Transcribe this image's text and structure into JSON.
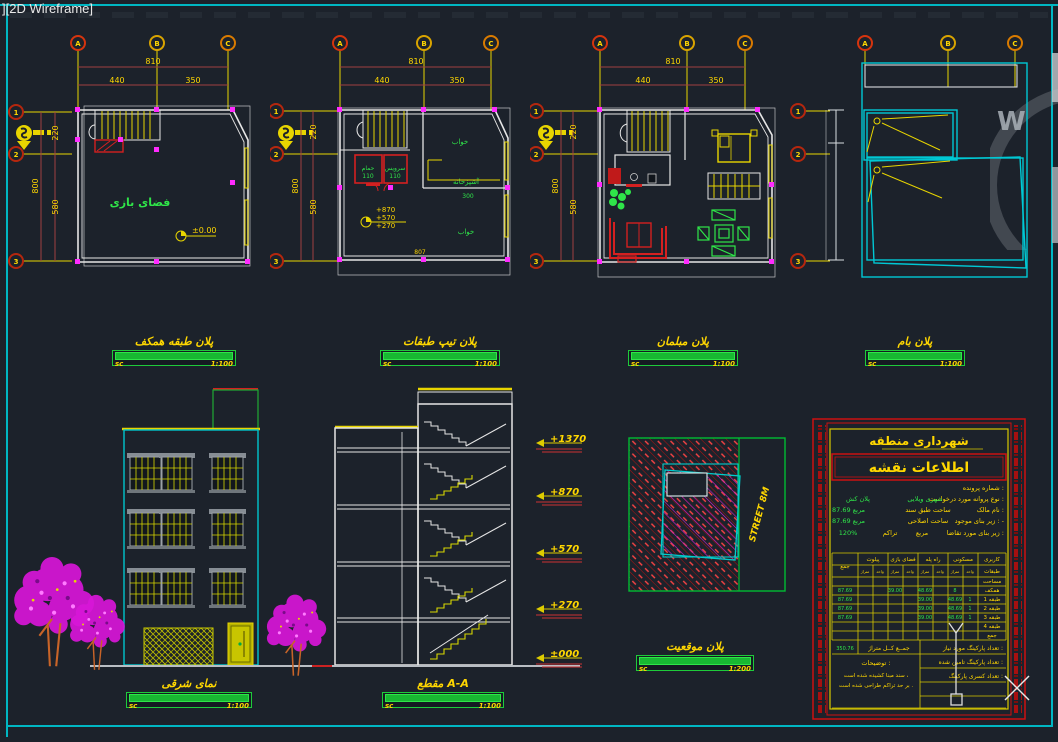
{
  "window": {
    "view_label": "][2D Wireframe]"
  },
  "viewcube": {
    "west": "W"
  },
  "bubbles": {
    "a": "A",
    "b": "B",
    "c": "C",
    "r1": "1",
    "r2": "2",
    "r3": "3"
  },
  "dims": {
    "total": "810",
    "left": "440",
    "right": "350",
    "v220": "220",
    "v800": "800",
    "v580": "580"
  },
  "scalebar": {
    "sc": "sc",
    "s100": "1:100",
    "s200": "1:200"
  },
  "plan_ground": {
    "title": "پلان طبقه همکف",
    "room": "فضای بازی",
    "level": "±0.00"
  },
  "plan_typical": {
    "title": "پلان تیپ طبقات",
    "bath": "حمام",
    "bath_dim": "110",
    "wc": "سرویس",
    "wc_dim": "110",
    "kitchen": "آشپزخانه",
    "kitchen_dim": "300",
    "bedroom": "خواب",
    "level1": "+870",
    "level2": "+570",
    "level3": "+270",
    "bottom_dim": "807"
  },
  "plan_furniture": {
    "title": "پلان مبلمان"
  },
  "plan_roof": {
    "title": "پلان بام"
  },
  "elevation": {
    "title": "نمای شرقی"
  },
  "section": {
    "title": "مقطع A-A",
    "l1": "+1370",
    "l2": "+870",
    "l3": "+570",
    "l4": "+270",
    "l5": "±000"
  },
  "site": {
    "title": "پلان موقعیت",
    "street": "STREET 8M"
  },
  "titleblock": {
    "header": "شهرداری منطقه",
    "subheader": "اطلاعات نقشه",
    "row1_label": "شماره پرونده :",
    "row2_label": "نوع پروانه مورد درخواست :",
    "row2_v1": "شهری ویلایی",
    "row2_v2": "پلان کش",
    "row3_label": "نام مالک :",
    "row3_mid": "ساحت طبق سند",
    "row3_val": "87.69 مربع",
    "row4_label": "زیر بنای موجود : -",
    "row4_mid": "ساحت اصلاحی",
    "row4_val": "87.69 مربع",
    "row5_label": "زیر بنای مورد تقاضا :",
    "row5_mid": "تراکم",
    "row5_mid2": "مربع",
    "row5_val": "120%",
    "table": {
      "h_karbari": "کاربری",
      "h_maskoni": "مسکونی",
      "h_rahpele": "راه پله",
      "h_faza": "فضای بازی",
      "h_pilot": "پیلوت",
      "h_jam": "جمع",
      "h_tabaghat": "طبقات",
      "h_unit": "واحد",
      "h_metraj": "متراژ",
      "r0": "مساحت",
      "r1": "همکف",
      "r2": "طبقه 1",
      "r3": "طبقه 2",
      "r4": "طبقه 3",
      "r5": "طبقه 4",
      "r6": "جمع",
      "g_total": "87.69",
      "g_m": "48.69",
      "g_u": "1",
      "g_s": "39.00",
      "g_gf_a": "48.69",
      "g_gf_b": "39.00",
      "g_gf_u": "8"
    },
    "total_label": "جمــع کــل متراژ",
    "total_value": "350.76",
    "park1": "تعداد پارکینگ مورد نیاز :",
    "park2": "تعداد پارکینگ تامین شده :",
    "park3": "تعداد کسری پارکینگ :",
    "notes_label": "توضیحات :",
    "note1": "سند مبنا کشیده شده است ،",
    "note2": "بر حد تراکم طراحی شده است ."
  }
}
